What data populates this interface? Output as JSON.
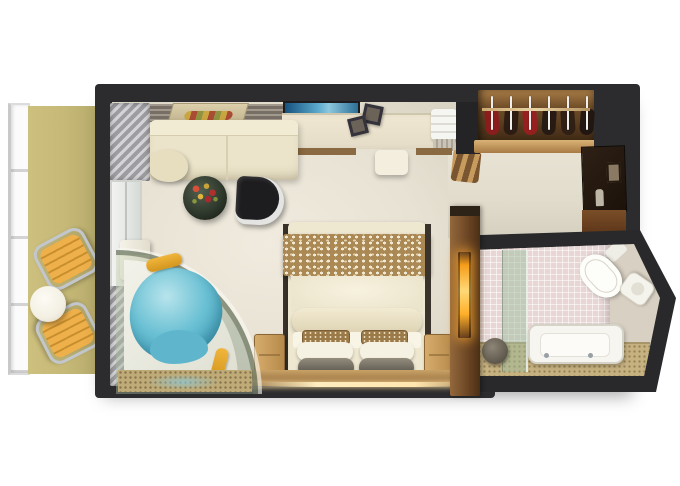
{
  "scene": {
    "type": "cruise-ship-stateroom-floor-plan-render",
    "background": "#ffffff",
    "rooms": [
      "balcony",
      "bedroom-living-area",
      "entry-hall",
      "wardrobe",
      "bathroom"
    ]
  },
  "colors": {
    "wall": "#2c2c2e",
    "carpet": "#e8e2d4",
    "hallCarpet": "#e2dccc",
    "balconyFloor": "#cdc07e",
    "chrome": "#c2c7cd",
    "loungeSlat": "#eeb04a",
    "tableTop": "#f3efe3",
    "sofa": "#ece4ca",
    "coffeeTable": "#222a20",
    "chairBlack": "#1d1d1f",
    "chairTrim": "#e4e4e2",
    "desk": "#e4dcc6",
    "deskWood": "#8a6a42",
    "artBlue": "#5aa8cc",
    "closetWood": "#6e4c28",
    "closetFrame": "#a87b44",
    "cabinetDark": "#1c120a",
    "rustFloor": "#5a3418",
    "bedDuvet": "#efe8d1",
    "bedThrow": "#ab8955",
    "pillowWhite": "#f6f2e3",
    "pillowGray": "#4e4a42",
    "pillowAccent": "#9b7a49",
    "nightstand": "#b68a4a",
    "woodFloor": "#8a6133",
    "headWallWood": "#6b4524",
    "glow": "#ffd977",
    "lampAmber": "#ffb02a",
    "curtain": "#9d9da1",
    "water": "#6cc1d4",
    "towelYellow": "#f0b53a",
    "tubWhite": "#f2f2ea",
    "bathTile": "#e7d6d4",
    "bathFloor": "#c6b181",
    "bathFixture": "#fdfdf9",
    "stool": "#4a443a"
  },
  "closet": {
    "hanger_count": 6,
    "garment_colors": [
      "#8e1a1c",
      "#2a1a12",
      "#9b1d20",
      "#241812",
      "#2e1d13",
      "#1e1410"
    ]
  },
  "balcony": {
    "lounge_chair_count": 2,
    "table_count": 1
  },
  "inventory": [
    "balcony-railing",
    "lounge-chair",
    "lounge-chair",
    "balcony-table",
    "sliding-glass-door",
    "curtains",
    "sofa-chaise",
    "coffee-table-with-flowers",
    "armchair",
    "wall-art",
    "desk",
    "desk-stool",
    "photo-frames",
    "towel",
    "wardrobe-with-hangers",
    "minibar-cabinet",
    "whirlpool-tub",
    "double-bed",
    "nightstand",
    "nightstand",
    "headboard-wall-lamp",
    "bathtub",
    "toilet",
    "sink",
    "shower-glass-panel",
    "bath-stool"
  ]
}
